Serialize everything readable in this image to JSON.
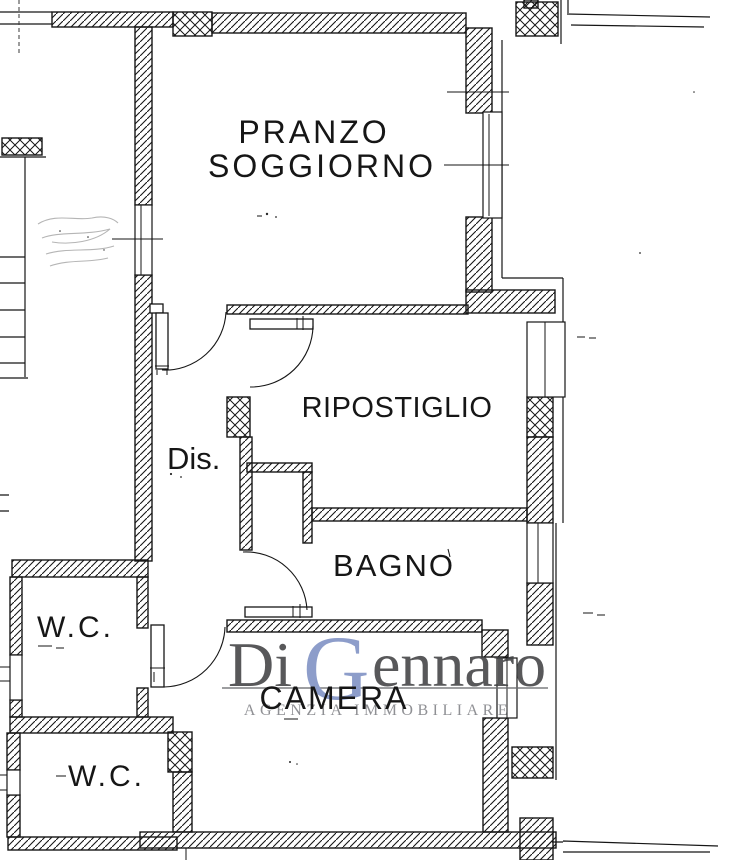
{
  "plan": {
    "rooms": {
      "pranzo_line1": "PRANZO",
      "pranzo_line2": "SOGGIORNO",
      "ripostiglio": "RIPOSTIGLIO",
      "disimpegno": "Dis.",
      "bagno": "BAGNO",
      "wc_upper": "W.C.",
      "camera": "CAMERA",
      "wc_lower": "W.C."
    },
    "watermark": {
      "name_prefix": "Di ",
      "name_initial": "G",
      "name_rest": "ennaro",
      "subtitle": "AGENZIA IMMOBILIARE",
      "name_color": "#414244",
      "initial_color": "#7e90c3",
      "subtitle_color": "#808186",
      "rule_color": "#6b6c6f"
    },
    "colors": {
      "ink": "#161616",
      "paper": "#ffffff"
    }
  }
}
